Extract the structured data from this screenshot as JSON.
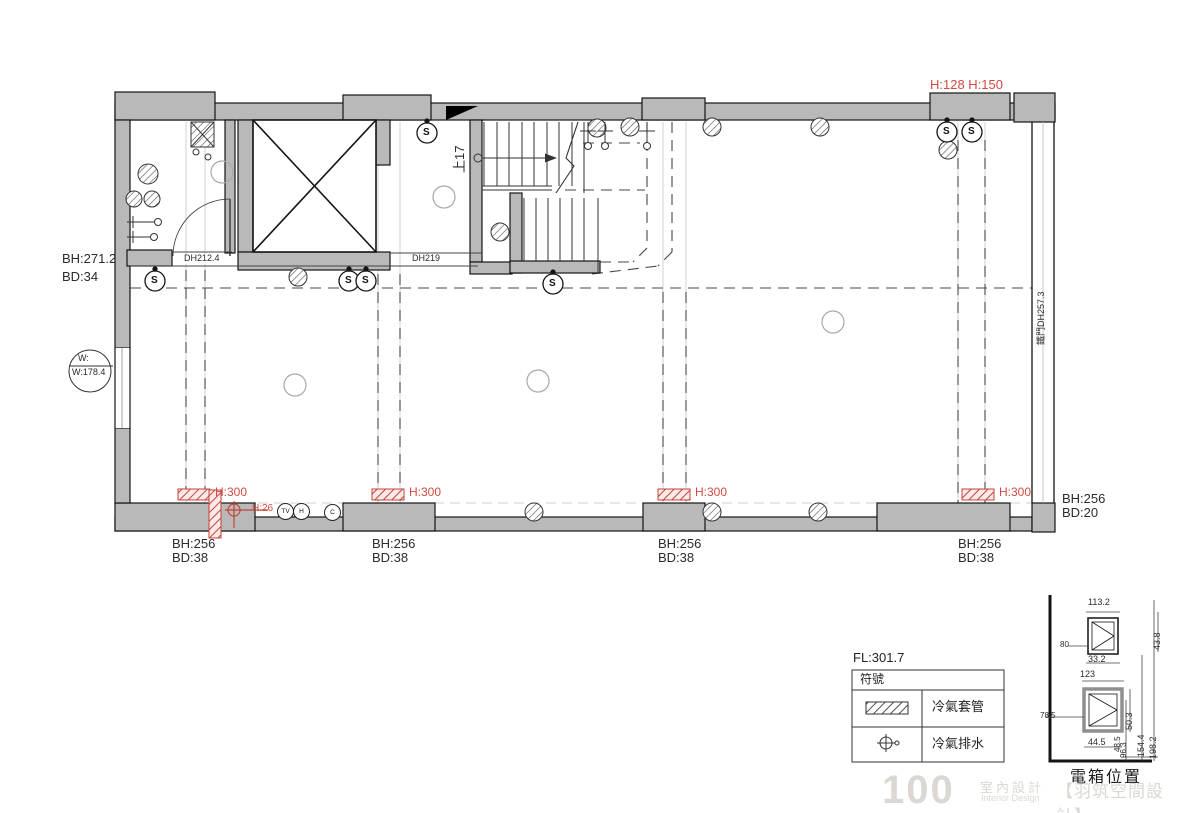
{
  "labels": {
    "top_right": "H:128 H:150",
    "left_bh": "BH:271.2",
    "left_bd": "BD:34",
    "window_top": "W:",
    "window_bottom": "W:178.4",
    "bath_door": "DH212.4",
    "hall_door": "DH219",
    "iron_door": "鐵門DH257.3",
    "stair_up": "上17",
    "h300": "H:300",
    "h26": "H:26",
    "s": "S",
    "outlet_tv": "TV",
    "outlet_h": "H",
    "outlet_c": "C",
    "bottom": [
      {
        "bh": "BH:256",
        "bd": "BD:38"
      },
      {
        "bh": "BH:256",
        "bd": "BD:38"
      },
      {
        "bh": "BH:256",
        "bd": "BD:38"
      },
      {
        "bh": "BH:256",
        "bd": "BD:38"
      }
    ],
    "right_bh": "BH:256",
    "right_bd": "BD:20"
  },
  "legend": {
    "title": "FL:301.7",
    "header": "符號",
    "row1": "冷氣套管",
    "row2": "冷氣排水"
  },
  "detail": {
    "title": "電箱位置",
    "box1": {
      "top": "113.2",
      "left": "80",
      "bottom": "33.2",
      "right": "43.8"
    },
    "box2": {
      "top": "123",
      "left": "78.5",
      "bottom": "44.5",
      "right": "50.3"
    },
    "v154": "154.4",
    "v198": "198.2",
    "v96": "96.3",
    "v48": "48.5"
  },
  "watermark": {
    "logo": "100",
    "cn": "室內設計",
    "en": "Interior Design",
    "studio": "【羽筑空間設計】"
  },
  "colors": {
    "red": "#d14b41",
    "wall": "#b9b9b9"
  }
}
